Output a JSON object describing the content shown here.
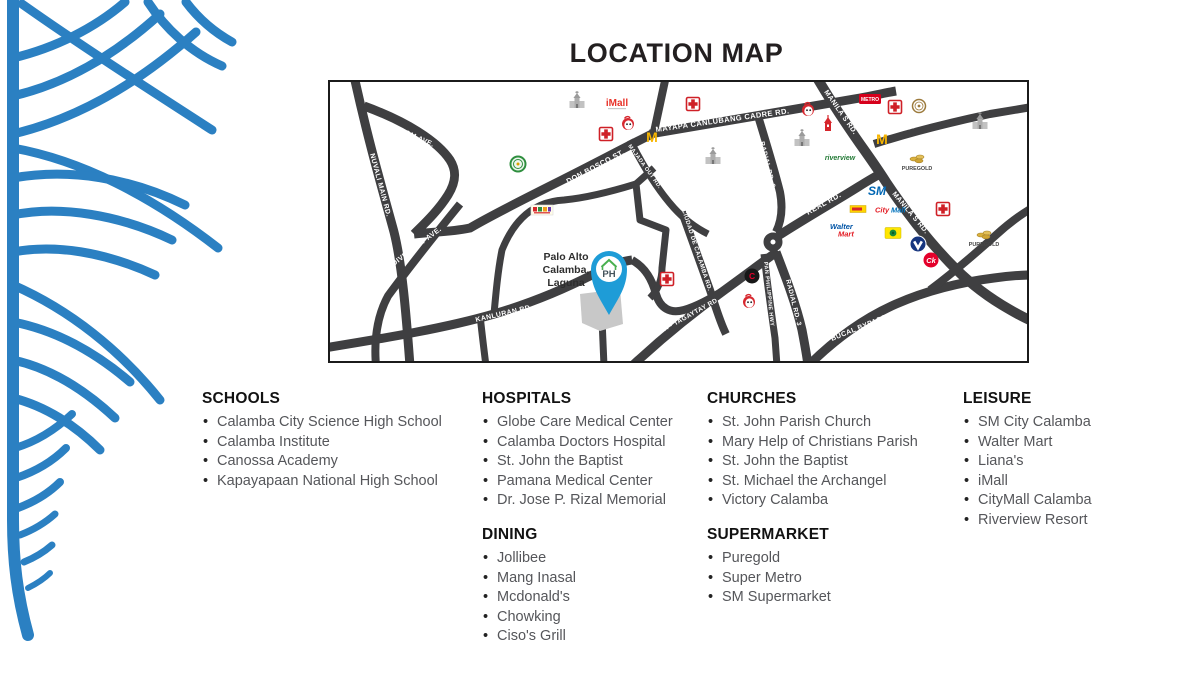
{
  "title": "LOCATION MAP",
  "map": {
    "place": {
      "line1": "Palo Alto",
      "line2": "Calamba,",
      "line3": "Laguna"
    },
    "pin_label": "PH",
    "roads": {
      "wisdom": "WISDOM AVE.",
      "nuvali": "NUVALI MAIN RD.",
      "diversity": "DIVERSITY AVE.",
      "kanluran": "KANLURAN RD.",
      "don_bosco": "DON BOSCO ST.",
      "majada": "MAJADA OUT RD.",
      "mayapa": "MAYAPA CANLUBANG CADRE RD.",
      "manila_s_upper": "MANILA S RD.",
      "manila_s_lower": "MANILA S RD.",
      "parian": "PARIAN RD.",
      "radial_upper": "RADIAL RD. 3",
      "radial_lower": "RADIAL RD. 3",
      "real": "REAL RD.",
      "pan_philippine": "PAN PHILIPPINE HWY",
      "ciudad": "CIUDAD DE CALAMBA RD.",
      "calamba_tagaytay": "CALAMBA - TAGAYTAY RD.",
      "bucal": "BUCAL BYPASS RD."
    },
    "logos": {
      "imall": "iMall",
      "metro": "METRO",
      "riverview": "riverview",
      "puregold1": "PUREGOLD",
      "puregold2": "PUREGOLD",
      "sm": "SM",
      "citymall_city": "City",
      "citymall_mall": "Mall",
      "walter": "Walter",
      "mart": "Mart",
      "ck": "Ck",
      "c": "C",
      "m": "M"
    }
  },
  "legend": {
    "schools": {
      "title": "SCHOOLS",
      "items": [
        "Calamba City Science High School",
        "Calamba Institute",
        "Canossa Academy",
        "Kapayapaan National High School"
      ]
    },
    "hospitals": {
      "title": "HOSPITALS",
      "items": [
        "Globe Care Medical Center",
        "Calamba Doctors Hospital",
        "St. John the Baptist",
        "Pamana Medical Center",
        "Dr. Jose P. Rizal Memorial"
      ]
    },
    "dining": {
      "title": "DINING",
      "items": [
        "Jollibee",
        "Mang Inasal",
        "Mcdonald's",
        "Chowking",
        "Ciso's Grill"
      ]
    },
    "churches": {
      "title": "CHURCHES",
      "items": [
        "St. John Parish Church",
        "Mary Help of Christians Parish",
        "St. John the Baptist",
        "St. Michael the Archangel",
        "Victory Calamba"
      ]
    },
    "supermarket": {
      "title": "SUPERMARKET",
      "items": [
        "Puregold",
        "Super Metro",
        "SM Supermarket"
      ]
    },
    "leisure": {
      "title": "LEISURE",
      "items": [
        "SM City Calamba",
        "Walter Mart",
        "Liana's",
        "iMall",
        "CityMall Calamba",
        "Riverview Resort"
      ]
    }
  },
  "colors": {
    "accent_blue": "#2b80c2",
    "road_gray": "#3f3f41",
    "pin_blue": "#1e9cd7",
    "title_dark": "#231f20"
  }
}
